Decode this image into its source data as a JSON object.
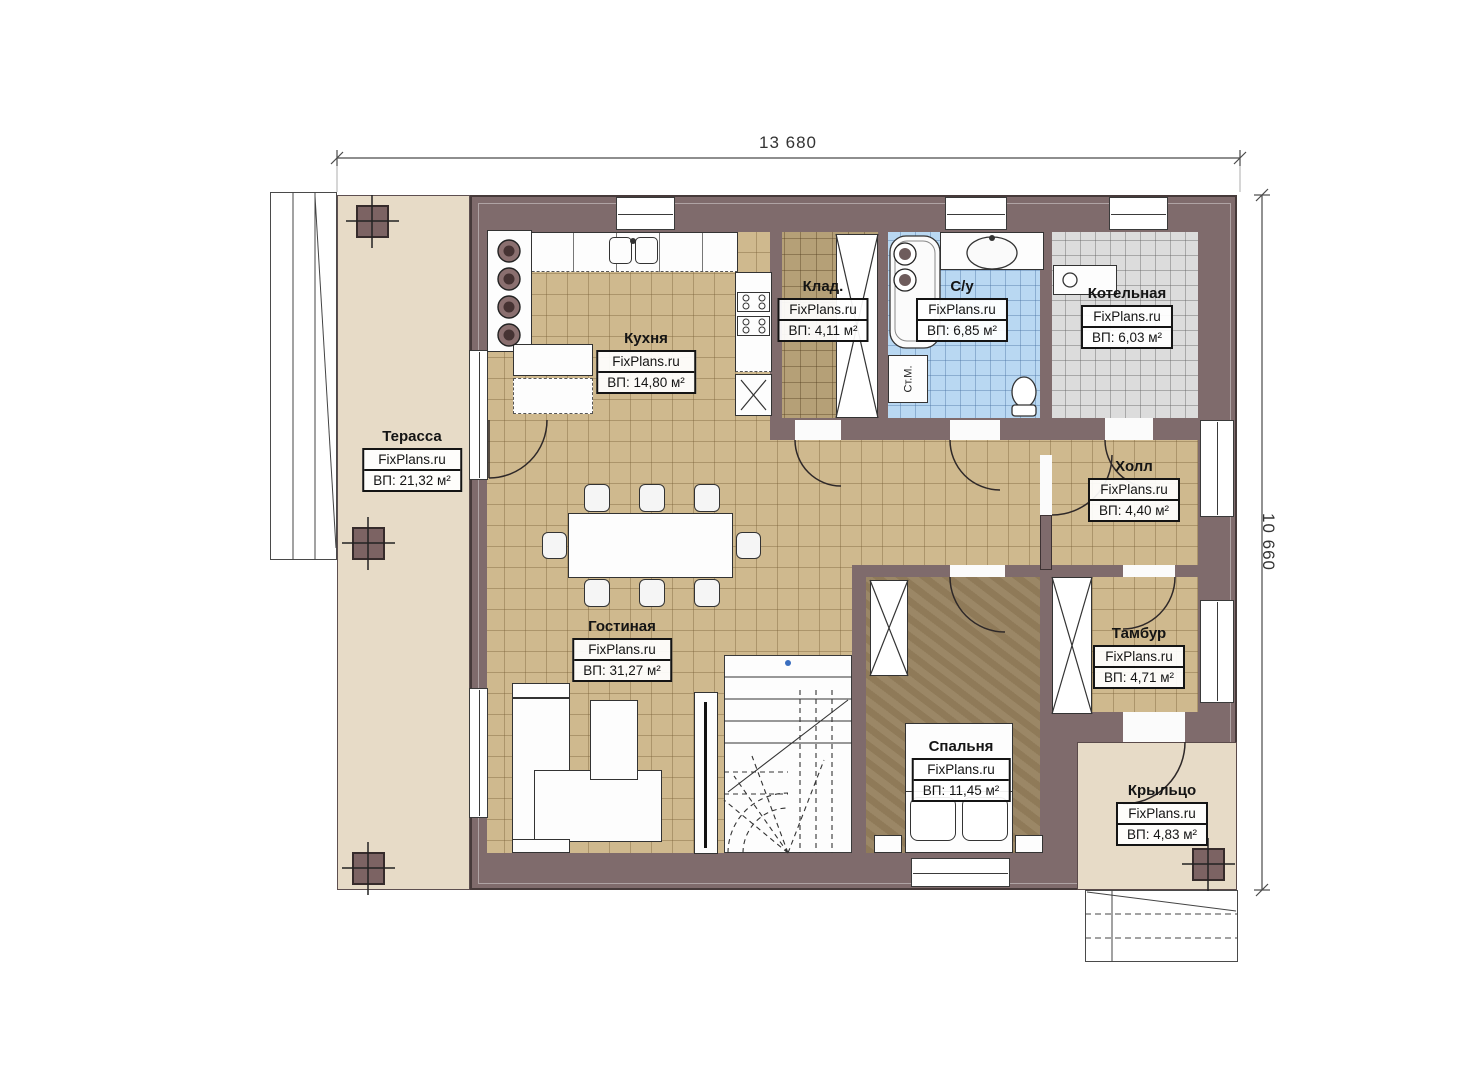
{
  "dimensions": {
    "width": "13 680",
    "height": "10 660"
  },
  "brand": "FixPlans.ru",
  "rooms": {
    "terrace": {
      "name": "Терасса",
      "area": "ВП: 21,32 м²"
    },
    "kitchen": {
      "name": "Кухня",
      "area": "ВП: 14,80 м²"
    },
    "storage": {
      "name": "Клад.",
      "area": "ВП: 4,11 м²"
    },
    "bathroom": {
      "name": "С/у",
      "area": "ВП: 6,85 м²"
    },
    "boiler": {
      "name": "Котельная",
      "area": "ВП: 6,03 м²"
    },
    "hall": {
      "name": "Холл",
      "area": "ВП: 4,40 м²"
    },
    "vestibule": {
      "name": "Тамбур",
      "area": "ВП: 4,71 м²"
    },
    "bedroom": {
      "name": "Спальня",
      "area": "ВП: 11,45 м²"
    },
    "living": {
      "name": "Гостиная",
      "area": "ВП: 31,27 м²"
    },
    "porch": {
      "name": "Крыльцо",
      "area": "ВП: 4,83 м²"
    }
  },
  "fixtures": {
    "washing_machine": "Ст.М."
  },
  "colors": {
    "wall": "#7f6b6c",
    "floor_tile": "#cfb98e",
    "terrace": "#e7dbc7",
    "bathroom_tile": "#b9d8f2",
    "boiler_tile": "#dcdcdc",
    "bedroom_floor": "#96815e",
    "storage_floor": "#b5a077"
  }
}
